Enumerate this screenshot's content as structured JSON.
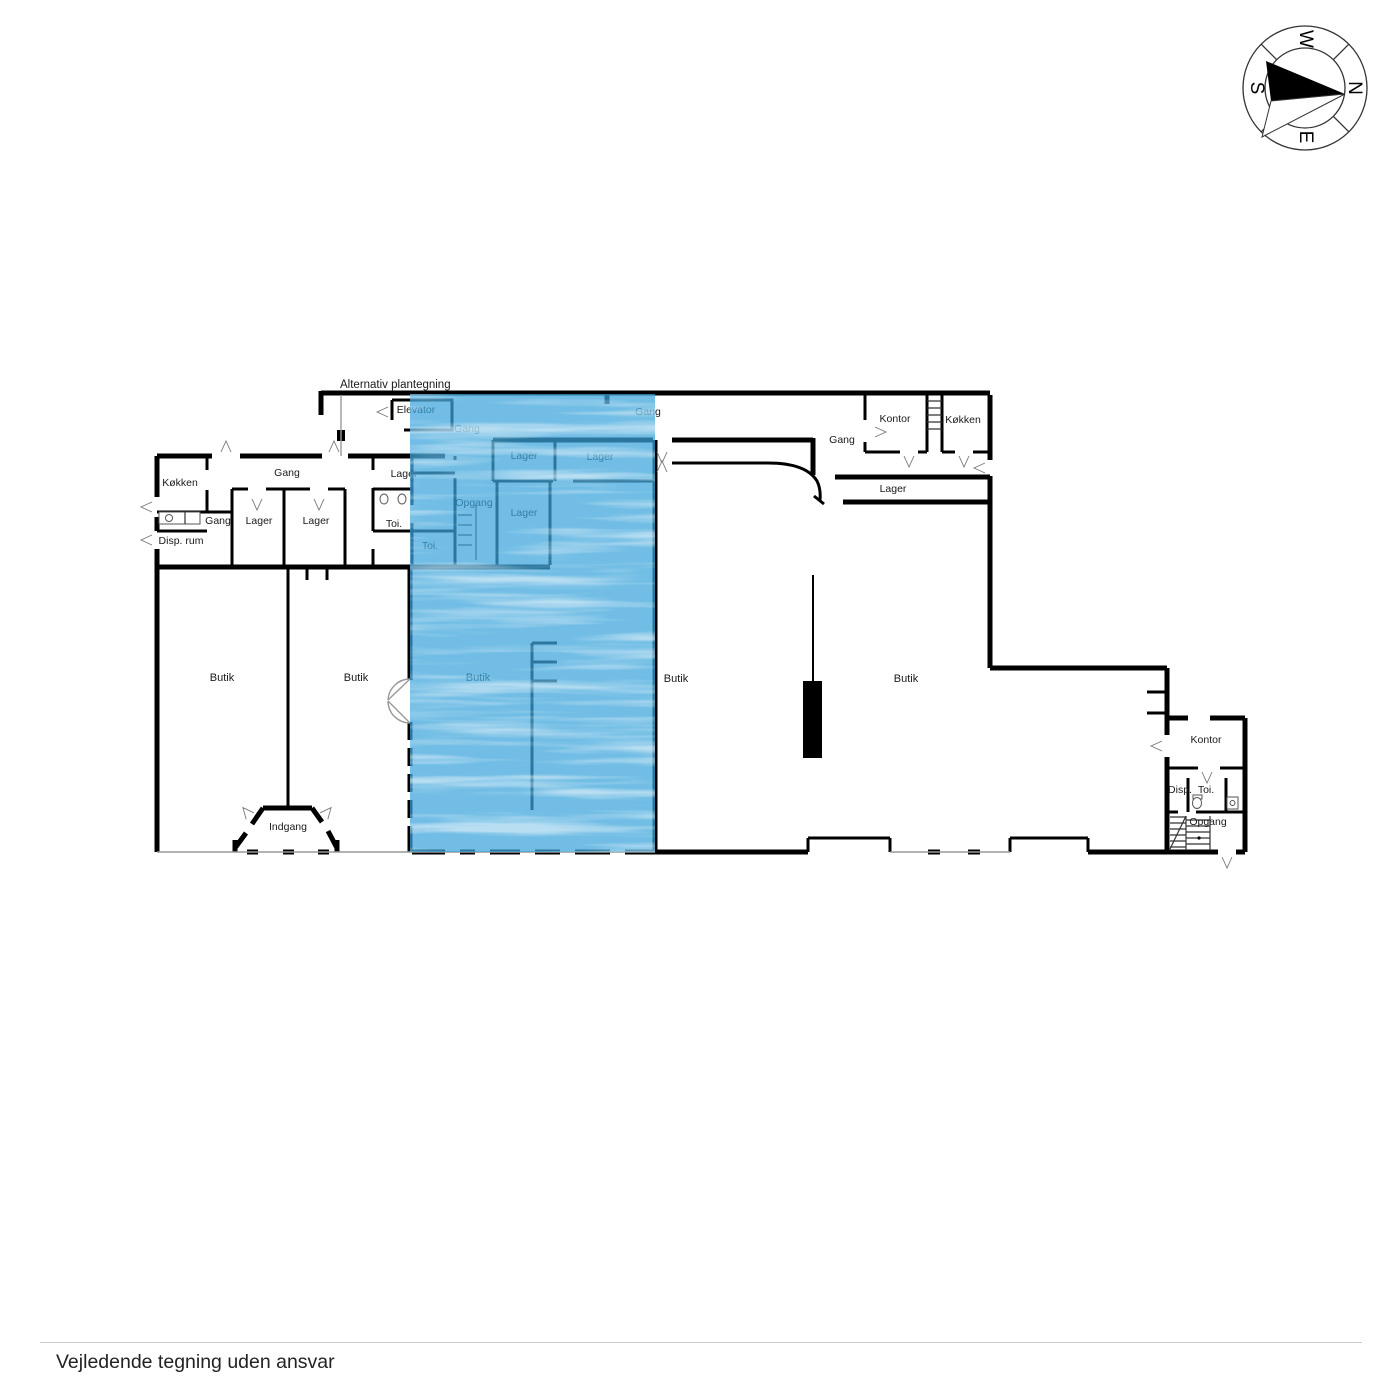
{
  "note": "Alternativ plantegning",
  "compass": {
    "n": "N",
    "e": "E",
    "s": "S",
    "w": "W"
  },
  "labels": [
    {
      "room": "koekken-left",
      "text": "Køkken"
    },
    {
      "room": "gang-left",
      "text": "Gang"
    },
    {
      "room": "gang-small",
      "text": "Gang"
    },
    {
      "room": "lager-left-1",
      "text": "Lager"
    },
    {
      "room": "lager-left-2",
      "text": "Lager"
    },
    {
      "room": "disp-rum",
      "text": "Disp. rum"
    },
    {
      "room": "lager-mid",
      "text": "Lager"
    },
    {
      "room": "toi-mid",
      "text": "Toi."
    },
    {
      "room": "toi-blue",
      "text": "Toi."
    },
    {
      "room": "elevator",
      "text": "Elevator"
    },
    {
      "room": "gang-blue",
      "text": "Gang"
    },
    {
      "room": "opgang-blue",
      "text": "Opgang"
    },
    {
      "room": "lager-blue-1",
      "text": "Lager"
    },
    {
      "room": "lager-blue-2",
      "text": "Lager"
    },
    {
      "room": "lager-blue-3",
      "text": "Lager"
    },
    {
      "room": "gang-top",
      "text": "Gang"
    },
    {
      "room": "gang-right",
      "text": "Gang"
    },
    {
      "room": "kontor-top",
      "text": "Kontor"
    },
    {
      "room": "koekken-right",
      "text": "Køkken"
    },
    {
      "room": "lager-corridor",
      "text": "Lager"
    },
    {
      "room": "butik-1",
      "text": "Butik"
    },
    {
      "room": "butik-2",
      "text": "Butik"
    },
    {
      "room": "butik-blue",
      "text": "Butik"
    },
    {
      "room": "butik-3",
      "text": "Butik"
    },
    {
      "room": "butik-4",
      "text": "Butik"
    },
    {
      "room": "indgang",
      "text": "Indgang"
    },
    {
      "room": "kontor-right",
      "text": "Kontor"
    },
    {
      "room": "disp-right",
      "text": "Disp."
    },
    {
      "room": "toi-right",
      "text": "Toi."
    },
    {
      "room": "opgang-right",
      "text": "Opgang"
    }
  ],
  "footer": {
    "disclaimer": "Vejledende tegning uden ansvar"
  },
  "colors": {
    "wall": "#000000",
    "highlight": "#3aa3db",
    "gray": "#999999",
    "rule": "#cccccc",
    "text": "#1a1a1a"
  }
}
